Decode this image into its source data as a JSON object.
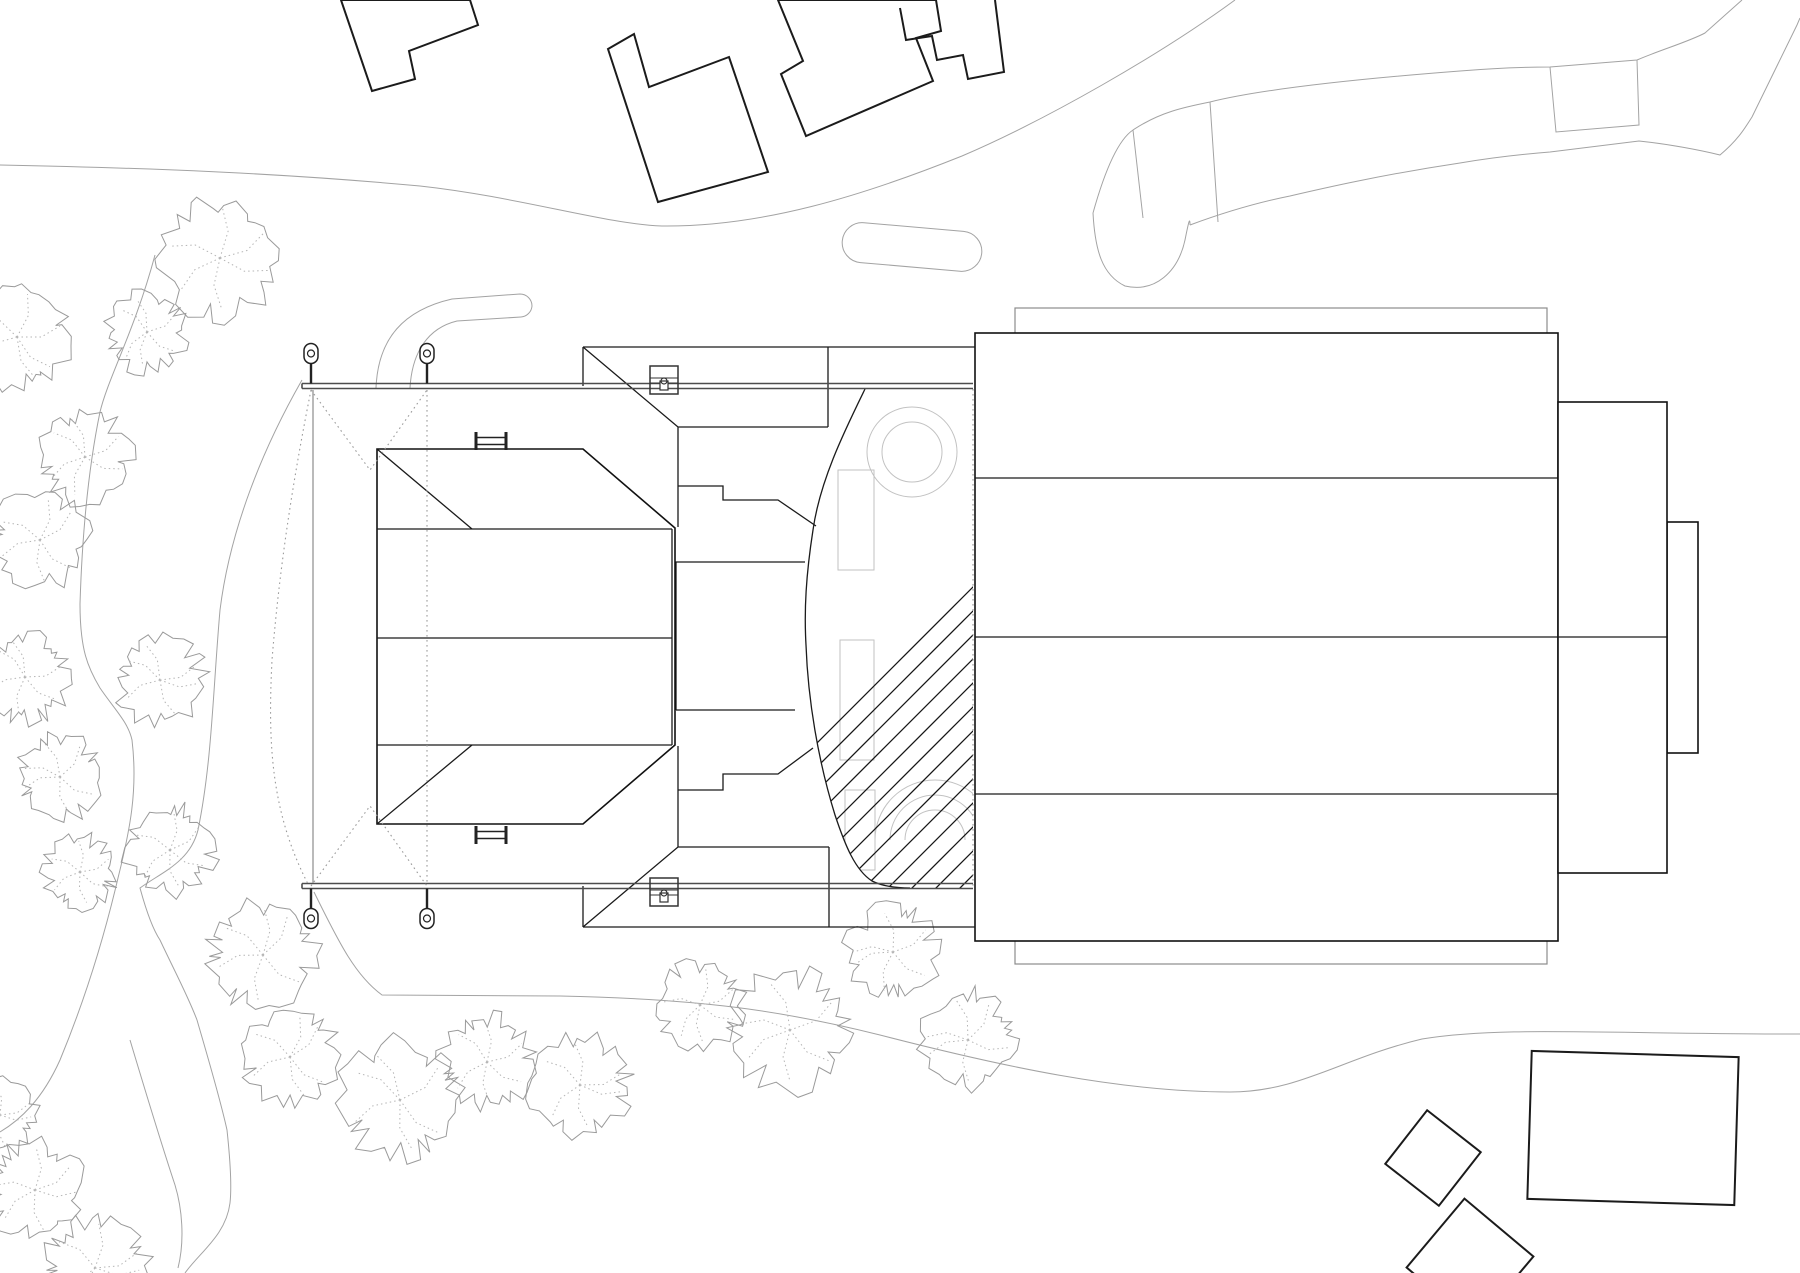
{
  "drawing": {
    "type": "architectural-site-plan",
    "orientation": "top-view",
    "background_color": "#ffffff",
    "line_colors": {
      "buildings_context": "#1b1b1b",
      "main_building": "#111111",
      "roads_paths": "#a3a3a3",
      "canopy_beams": "#4d4d4d",
      "construction_dotted": "#9a9a9a",
      "tree_outline": "#9a9a9a",
      "tree_branches": "#b5b5b5",
      "hatch": "#161616",
      "interior_detail": "#c2c2c2"
    }
  },
  "hatch": {
    "angle_deg": 45,
    "spacing_px": 24,
    "x_start": 600,
    "x_end": 1780,
    "y_low": 960,
    "length": 640
  },
  "beams": {
    "top": {
      "y1": 383.5,
      "y2": 388.5,
      "x_start": 302,
      "x_end": 973
    },
    "bottom": {
      "y1": 883.5,
      "y2": 888.5,
      "x_start": 302,
      "x_end": 973
    }
  },
  "poles": [
    {
      "x": 311,
      "side": "top"
    },
    {
      "x": 427,
      "side": "top"
    },
    {
      "x": 311,
      "side": "bottom"
    },
    {
      "x": 427,
      "side": "bottom"
    }
  ],
  "benches": [
    {
      "x1": 476,
      "x2": 506,
      "y_top": 432,
      "y_bot": 450
    },
    {
      "x1": 476,
      "x2": 506,
      "y_top": 826,
      "y_bot": 844
    }
  ],
  "tables": [
    {
      "cx": 664,
      "y_top": 366,
      "w": 28,
      "h": 28
    },
    {
      "cx": 664,
      "y_top": 878,
      "w": 28,
      "h": 28
    }
  ],
  "trees": [
    {
      "x": 220,
      "y": 258,
      "r": 62,
      "seed": 3
    },
    {
      "x": 147,
      "y": 332,
      "r": 42,
      "seed": 5
    },
    {
      "x": 17,
      "y": 337,
      "r": 54,
      "seed": 7
    },
    {
      "x": 85,
      "y": 457,
      "r": 48,
      "seed": 11
    },
    {
      "x": 40,
      "y": 540,
      "r": 50,
      "seed": 13
    },
    {
      "x": 25,
      "y": 677,
      "r": 46,
      "seed": 17
    },
    {
      "x": 160,
      "y": 680,
      "r": 46,
      "seed": 19
    },
    {
      "x": 60,
      "y": 777,
      "r": 44,
      "seed": 23
    },
    {
      "x": 80,
      "y": 872,
      "r": 38,
      "seed": 29
    },
    {
      "x": 170,
      "y": 850,
      "r": 46,
      "seed": 31
    },
    {
      "x": 263,
      "y": 955,
      "r": 56,
      "seed": 37
    },
    {
      "x": 290,
      "y": 1057,
      "r": 50,
      "seed": 41
    },
    {
      "x": 400,
      "y": 1100,
      "r": 62,
      "seed": 43
    },
    {
      "x": 487,
      "y": 1062,
      "r": 48,
      "seed": 47
    },
    {
      "x": 580,
      "y": 1085,
      "r": 52,
      "seed": 53
    },
    {
      "x": 700,
      "y": 1005,
      "r": 44,
      "seed": 59
    },
    {
      "x": 790,
      "y": 1030,
      "r": 62,
      "seed": 61
    },
    {
      "x": 893,
      "y": 952,
      "r": 48,
      "seed": 67
    },
    {
      "x": 968,
      "y": 1040,
      "r": 50,
      "seed": 71
    },
    {
      "x": 0,
      "y": 1115,
      "r": 38,
      "seed": 73
    },
    {
      "x": 35,
      "y": 1190,
      "r": 50,
      "seed": 79
    },
    {
      "x": 95,
      "y": 1268,
      "r": 54,
      "seed": 83
    }
  ]
}
